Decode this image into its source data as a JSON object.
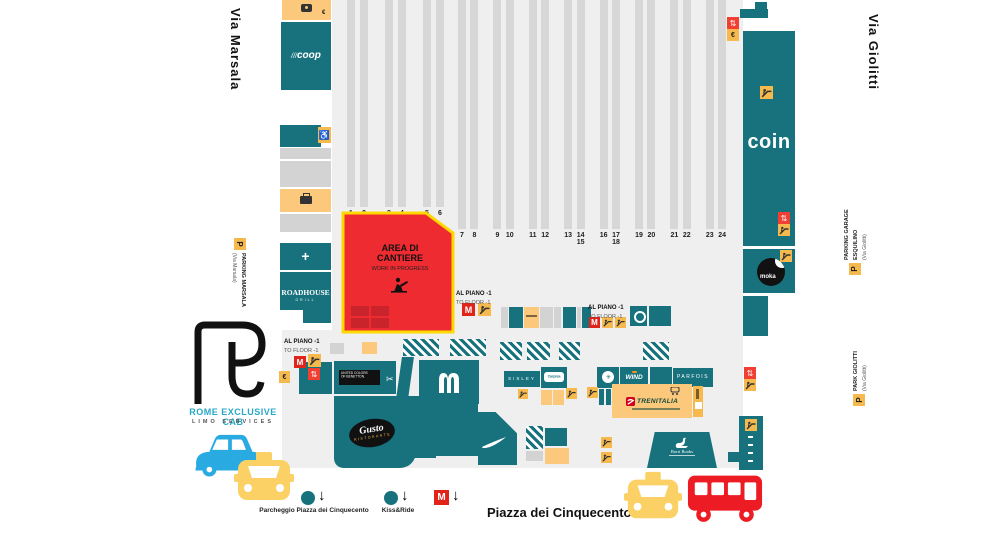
{
  "streets": {
    "left": "Via Marsala",
    "right": "Via Giolitti",
    "square": "Piazza dei Cinquecento"
  },
  "parking": {
    "marsala": {
      "p": "P",
      "name": "PARKING MARSALA",
      "via": "(Via Marsala)"
    },
    "esquilino": {
      "p": "P",
      "name": "PARKING GARAGE",
      "name2": "ESQUILINO",
      "via": "(Via Giolitti)"
    },
    "giolitti": {
      "p": "P",
      "name": "PARK GIOLITTI",
      "via": "(Via Giolitti)"
    }
  },
  "construction": {
    "l1": "AREA DI",
    "l2": "CANTIERE",
    "sub": "WORK IN PROGRESS"
  },
  "floor": {
    "line1": "AL PIANO -1",
    "line2": "TO FLOOR -1"
  },
  "platforms": {
    "left_group": [
      "1",
      "2",
      "3",
      "4",
      "5",
      "6"
    ],
    "right_group": [
      "7",
      "8",
      "9",
      "10",
      "11",
      "12",
      "13",
      "14/15",
      "16",
      "17/18",
      "19",
      "20",
      "21",
      "22",
      "23",
      "24"
    ]
  },
  "brands": {
    "coop": "coop",
    "coin": "coin",
    "moka": "moka",
    "roadhouse": "ROADHOUSE",
    "roadhouse_sub": "GRILL",
    "benetton_l1": "UNITED COLORS",
    "benetton_l2": "OF BENETTON.",
    "gusto": "Gusto",
    "gusto_sub": "RISTORANTE",
    "sisley": "SISLEY",
    "carpisa": "Carpisa",
    "wind": "WIND",
    "parfois": "PARFOIS",
    "trenitalia": "TRENITALIA",
    "borri": "Borri Books",
    "metro_m": "M"
  },
  "rec_logo": {
    "title": "ROME EXCLUSIVE CAB",
    "subtitle": "LIMO SERVICES"
  },
  "legend": {
    "parcheggio": "Parcheggio Piazza dei Cinquecento",
    "kiss": "Kiss&Ride"
  },
  "icons": {
    "euro": "€",
    "down_arrow": "↓",
    "wheelchair": "♿",
    "elevator": "⇅",
    "cross": "+"
  },
  "colors": {
    "teal": "#17727e",
    "orange_block": "#fbc87c",
    "chip_orange": "#f6b94d",
    "construction_red": "#ee2b31",
    "construction_border": "#ffd800",
    "metro_red": "#e2231a",
    "taxi_yellow": "#fbd064",
    "bus_red": "#ed1c24",
    "car_blue": "#29abe2",
    "platform_gray": "#d7d7d7",
    "ground_gray": "#efefef"
  }
}
